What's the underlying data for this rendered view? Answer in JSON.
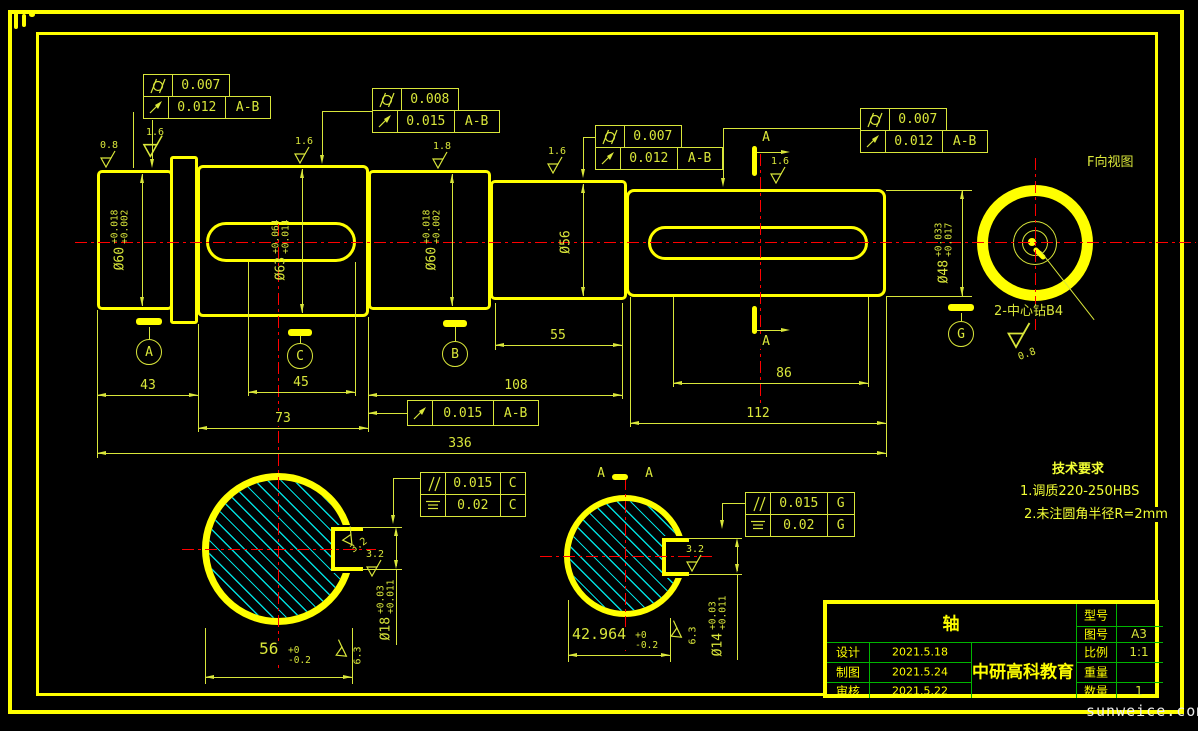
{
  "colors": {
    "outline": "#ffff00",
    "thin_lines": "#d9e63a",
    "centerline": "#ff0000",
    "hatch": "#00dcdc",
    "table_grid": "#00b400"
  },
  "icons": {
    "cylindricity": "circle-with-two-slashes",
    "circular_runout": "arrow-up-right",
    "parallelism": "double-slash",
    "symmetry": "three-horizontal-lines",
    "roughness": "check-with-triangle",
    "datum": "circled-letter"
  },
  "front_view": {
    "fcf1": {
      "r1val": "0.007",
      "r2val": "0.012",
      "r2datum": "A-B"
    },
    "fcf2": {
      "r1val": "0.008",
      "r2val": "0.015",
      "r2datum": "A-B"
    },
    "fcf3": {
      "r1val": "0.007",
      "r2val": "0.012",
      "r2datum": "A-B"
    },
    "fcf4": {
      "r1val": "0.007",
      "r2val": "0.012",
      "r2datum": "A-B"
    },
    "fcf5": {
      "val": "0.015",
      "datum": "A-B"
    },
    "dia": {
      "s1": {
        "d": "Ø60",
        "up": "+0.018",
        "lo": "+0.002"
      },
      "s2": {
        "d": "Ø63",
        "up": "+0.064",
        "lo": "+0.014"
      },
      "s3": {
        "d": "Ø60",
        "up": "+0.018",
        "lo": "+0.002"
      },
      "s4": {
        "d": "Ø56"
      },
      "s5": {
        "d": "Ø48",
        "up": "+0.033",
        "lo": "+0.017"
      }
    },
    "len": {
      "l43": "43",
      "l45": "45",
      "l73": "73",
      "l55": "55",
      "l108": "108",
      "l86": "86",
      "l112": "112",
      "l336": "336"
    },
    "rough": {
      "r1": "0.8",
      "r2": "1.6",
      "r3": "1.6",
      "r4": "1.8",
      "r5": "1.6",
      "r6": "1.6"
    },
    "datum": {
      "a": "A",
      "c": "C",
      "b": "B",
      "g": "G"
    },
    "cut": {
      "top": "A",
      "bottom": "A"
    }
  },
  "view_f": {
    "title": "F向视图",
    "note": "2-中心钻B4",
    "rough": "0.8"
  },
  "section_c": {
    "fcf": {
      "r1val": "0.015",
      "r1datum": "C",
      "r2val": "0.02",
      "r2datum": "C"
    },
    "w": "56",
    "wup": "+0",
    "wlo": "-0.2",
    "k": "Ø18",
    "kup": "+0.03",
    "klo": "+0.011",
    "rkey1": "3.2",
    "rkey2": "3.2",
    "router": "6.3"
  },
  "section_aa": {
    "t1": "A",
    "t2": "A",
    "fcf": {
      "r1val": "0.015",
      "r1datum": "G",
      "r2val": "0.02",
      "r2datum": "G"
    },
    "w": "42.964",
    "wup": "+0",
    "wlo": "-0.2",
    "k": "Ø14",
    "kup": "+0.03",
    "klo": "+0.011",
    "rkey": "3.2",
    "router": "6.3"
  },
  "tech": {
    "title": "技术要求",
    "l1": "1.调质220-250HBS",
    "l2": "2.未注圆角半径R=2mm"
  },
  "title_block": {
    "part": "轴",
    "model_l": "型号",
    "model_v": "",
    "draw_no_l": "图号",
    "draw_no_v": "A3",
    "scale_l": "比例",
    "scale_v": "1:1",
    "weight_l": "重量",
    "weight_v": "",
    "qty_l": "数量",
    "qty_v": "1",
    "design_l": "设计",
    "design_v": "2021.5.18",
    "draft_l": "制图",
    "draft_v": "2021.5.24",
    "audit_l": "审核",
    "audit_v": "2021.5.22",
    "company": "中研高科教育"
  },
  "watermark": "sunweice.com"
}
